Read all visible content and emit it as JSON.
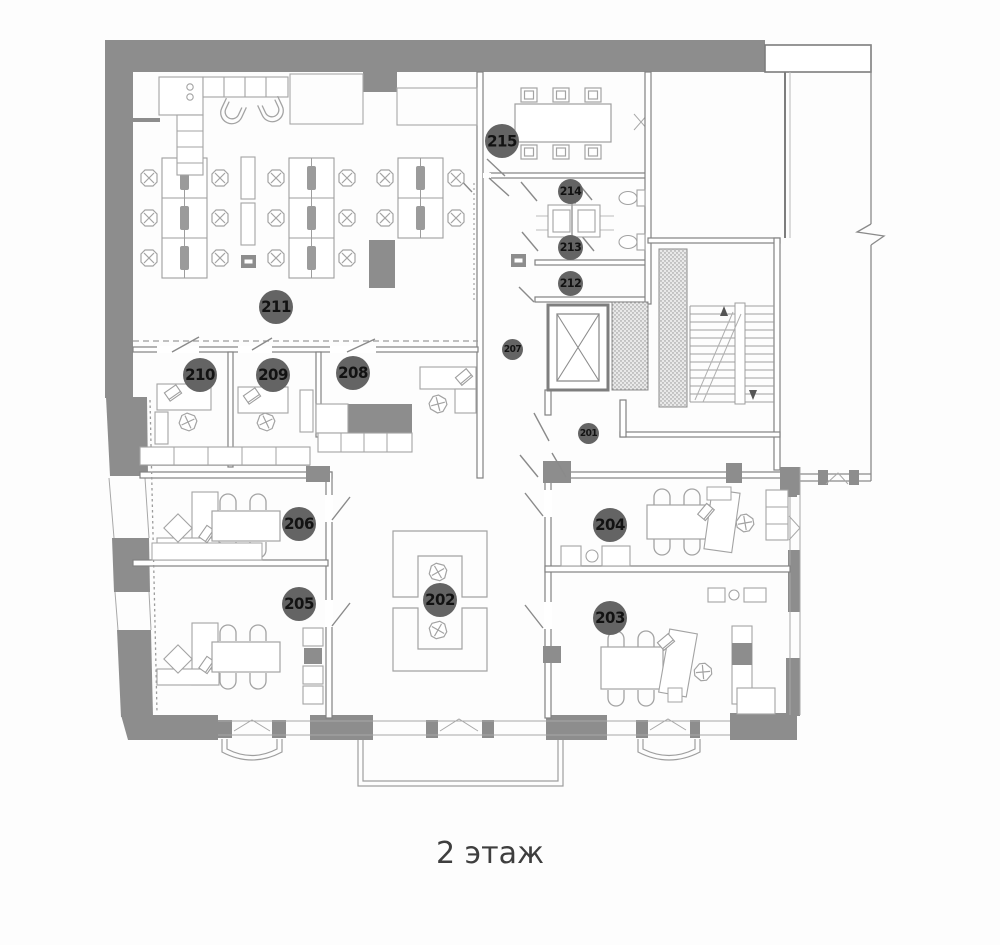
{
  "title": "2 этаж",
  "rooms": [
    {
      "number": "215"
    },
    {
      "number": "214"
    },
    {
      "number": "213"
    },
    {
      "number": "212"
    },
    {
      "number": "211"
    },
    {
      "number": "210"
    },
    {
      "number": "209"
    },
    {
      "number": "208"
    },
    {
      "number": "207"
    },
    {
      "number": "201"
    },
    {
      "number": "206"
    },
    {
      "number": "204"
    },
    {
      "number": "205"
    },
    {
      "number": "202"
    },
    {
      "number": "203"
    }
  ],
  "colors": {
    "wall": "#8d8d8d",
    "wall_line": "#818181",
    "furniture_line": "#a6a6a6",
    "badge": "#646464",
    "badge_text": "#121212",
    "background": "#fdfdfd"
  }
}
